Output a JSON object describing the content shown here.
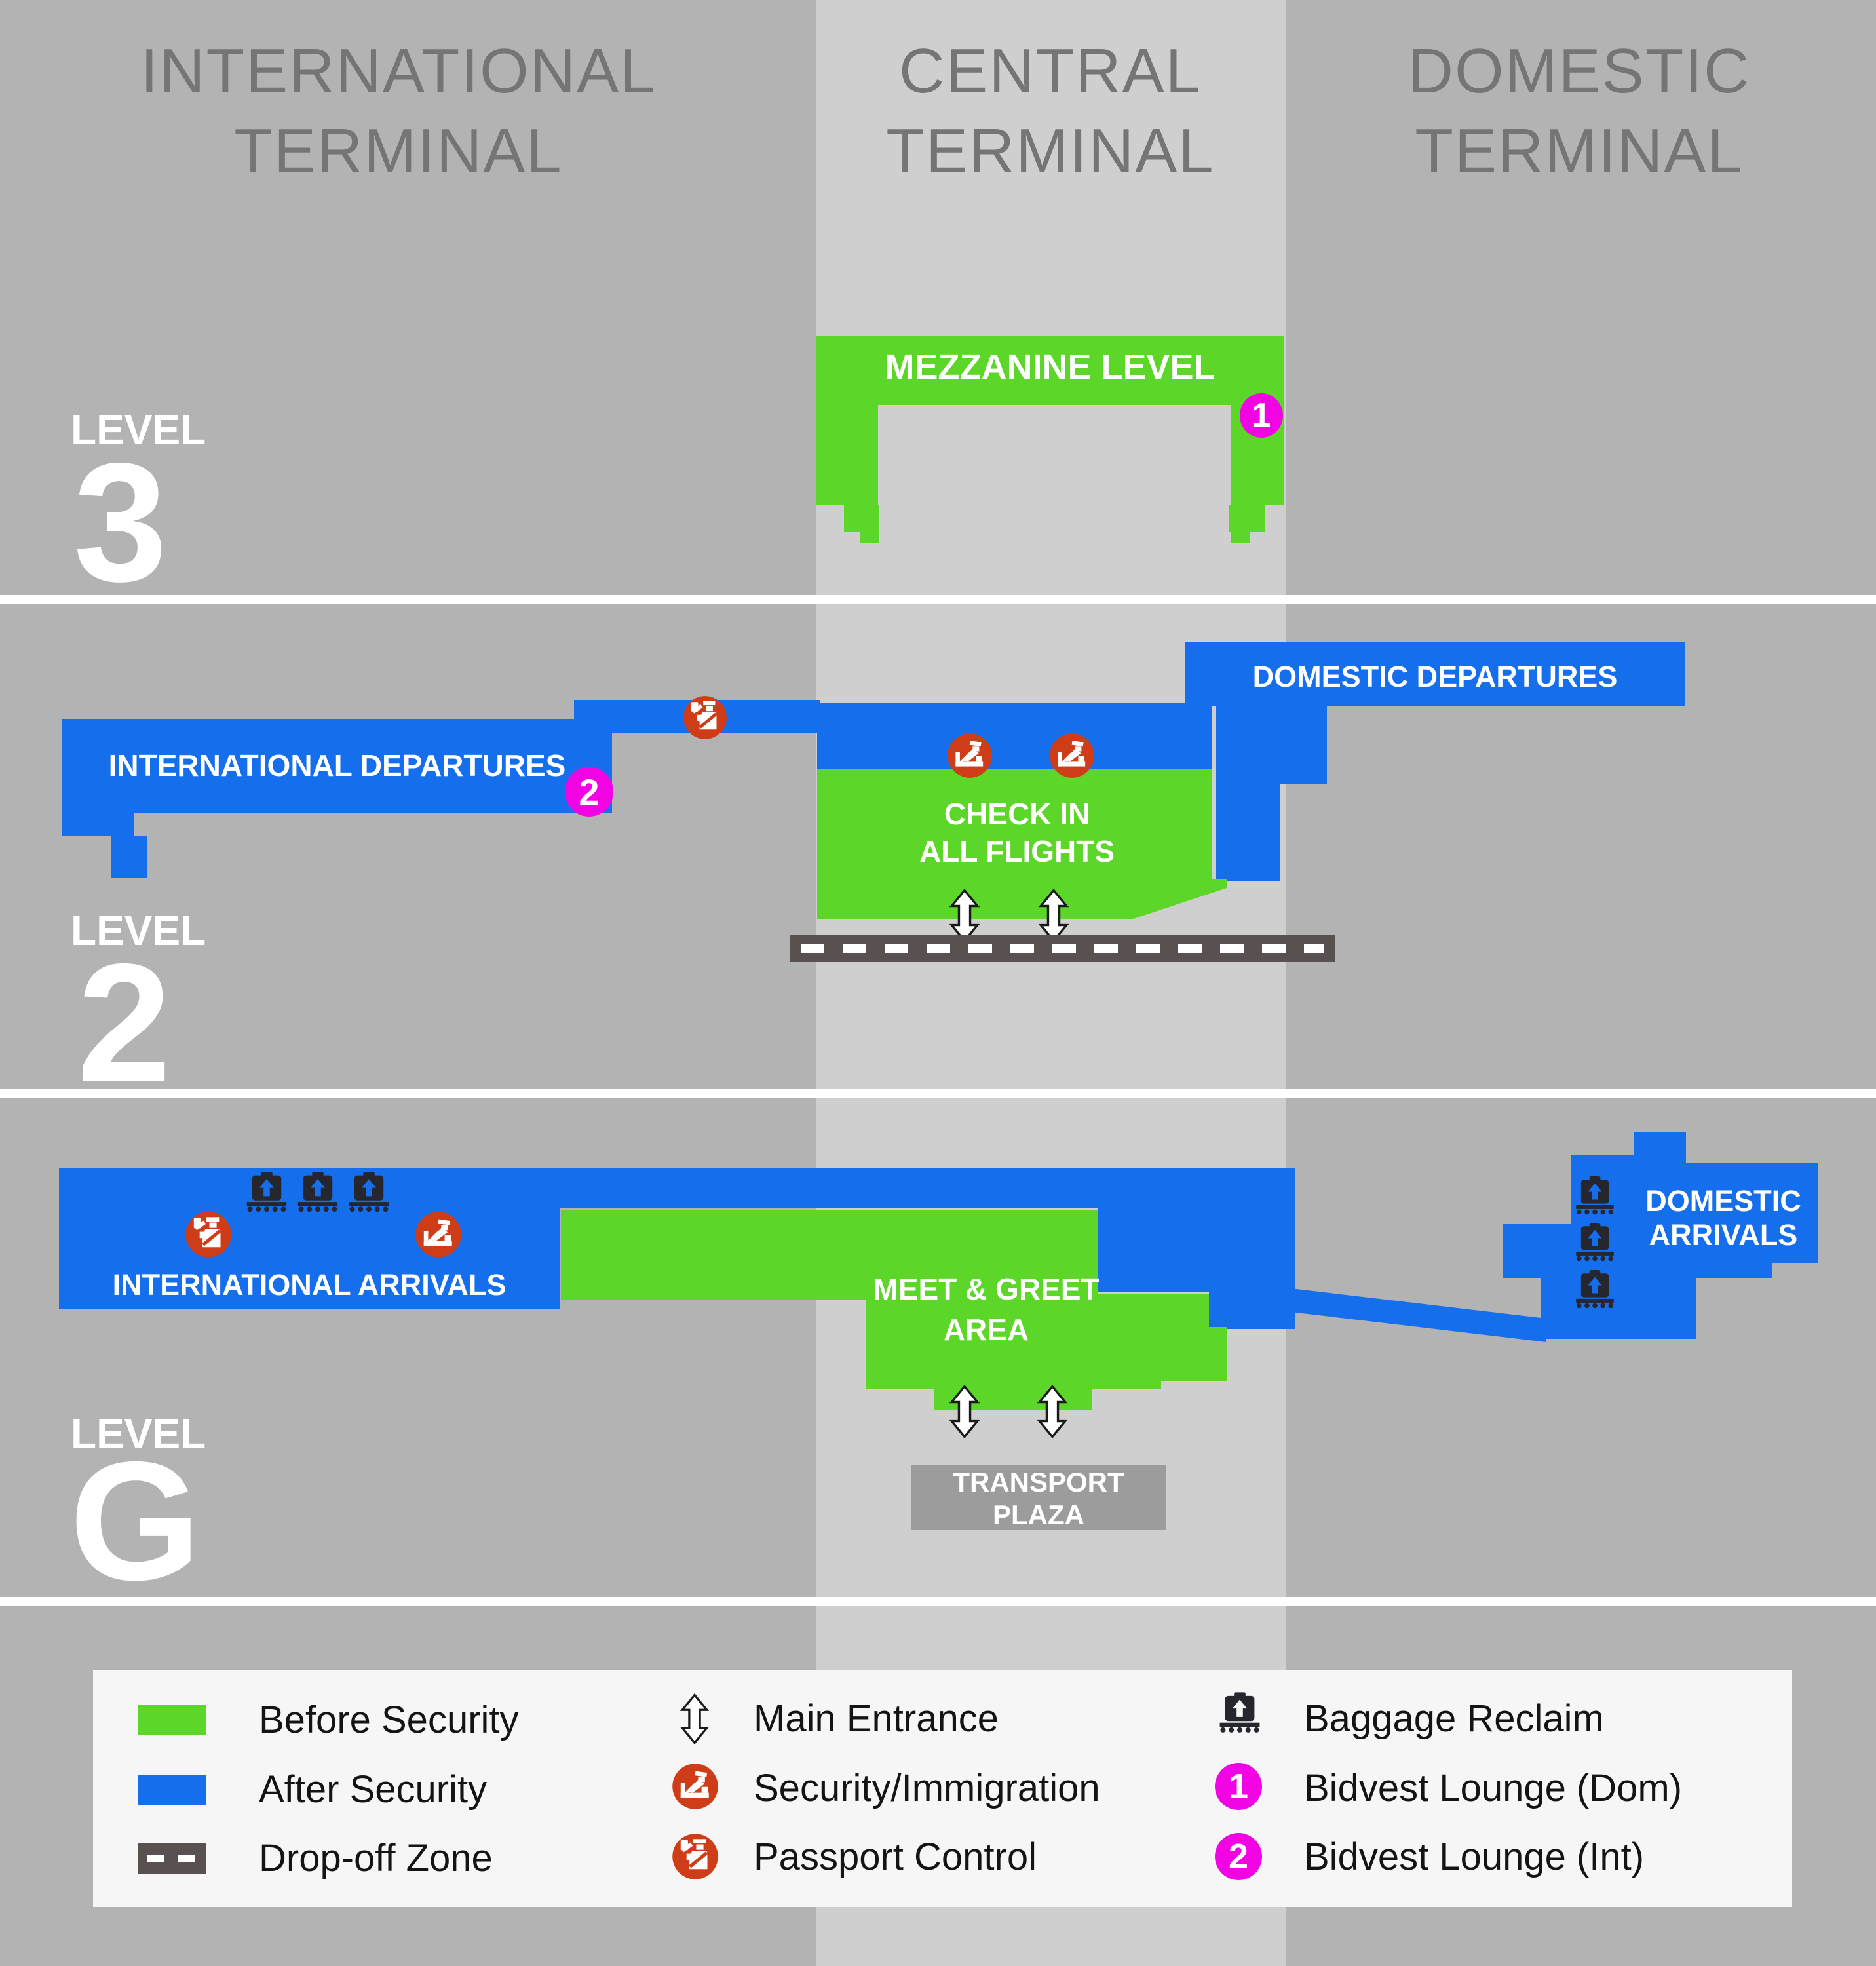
{
  "headers": {
    "international": [
      "INTERNATIONAL",
      "TERMINAL"
    ],
    "central": [
      "CENTRAL",
      "TERMINAL"
    ],
    "domestic": [
      "DOMESTIC",
      "TERMINAL"
    ]
  },
  "levels": {
    "l3": {
      "word": "LEVEL",
      "num": "3"
    },
    "l2": {
      "word": "LEVEL",
      "num": "2"
    },
    "lg": {
      "word": "LEVEL",
      "num": "G"
    }
  },
  "map": {
    "mezzanine": "MEZZANINE LEVEL",
    "intl_departures": "INTERNATIONAL DEPARTURES",
    "domestic_departures": "DOMESTIC DEPARTURES",
    "check_in": [
      "CHECK IN",
      "ALL FLIGHTS"
    ],
    "intl_arrivals": "INTERNATIONAL ARRIVALS",
    "meet_greet": [
      "MEET & GREET",
      "AREA"
    ],
    "domestic_arrivals": [
      "DOMESTIC",
      "ARRIVALS"
    ],
    "transport_plaza": [
      "TRANSPORT",
      "PLAZA"
    ],
    "badge_dom": "1",
    "badge_int": "2"
  },
  "legend": {
    "before_security": "Before Security",
    "after_security": "After Security",
    "dropoff_zone": "Drop-off Zone",
    "main_entrance": "Main Entrance",
    "security_immigration": "Security/Immigration",
    "passport_control": "Passport Control",
    "baggage_reclaim": "Baggage Reclaim",
    "bidvest_dom": "Bidvest Lounge (Dom)",
    "bidvest_int": "Bidvest Lounge (Int)"
  },
  "colors": {
    "green": "#5CD628",
    "blue": "#156FEC",
    "magenta": "#F203E3",
    "orange": "#CE3D18",
    "road": "#585150",
    "bg": "#B3B3B3",
    "col": "#CFCFCF",
    "legendbg": "#F6F6F6",
    "plaza": "#9C9C9C",
    "bagdark": "#26262E",
    "headerc": "#757575",
    "textc": "#141414"
  }
}
